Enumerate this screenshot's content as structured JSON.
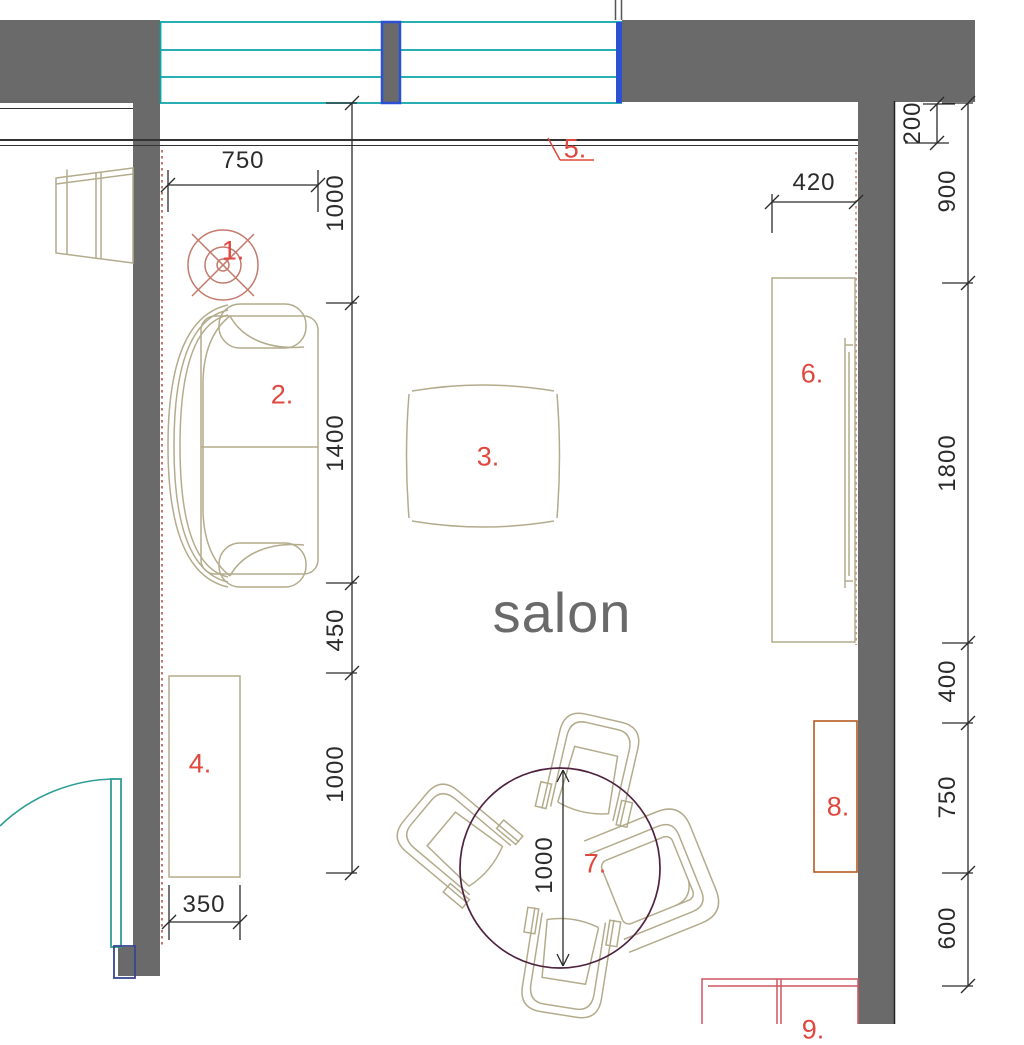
{
  "room_label": "salon",
  "labels": {
    "1": "1.",
    "2": "2.",
    "3": "3.",
    "4": "4.",
    "5": "5.",
    "6": "6.",
    "7": "7.",
    "8": "8.",
    "9": "9."
  },
  "dims": {
    "top_width": "750",
    "left_chain": [
      "1000",
      "1400",
      "450",
      "1000"
    ],
    "cabinet_width": "350",
    "tv_offset": "420",
    "wall_offset": "200",
    "right_chain": [
      "900",
      "1800",
      "400",
      "750",
      "600"
    ],
    "table_diameter": "1000"
  },
  "colors": {
    "wall_gray": "#6a6a6a",
    "window_teal": "#0aa3a8",
    "mullion_blue": "#2b50d4",
    "door_teal": "#2f9e96",
    "door_frame_navy": "#37478f",
    "furniture_beige": "#b3ac8c",
    "label_red": "#e0483f",
    "light_symbol_salmon": "#c4796b",
    "table_plum": "#4f2240",
    "cabinet8_orange": "#b55a1f",
    "sideboard_pink": "#cf5560",
    "dimension_ink": "#2b2b2b",
    "room_label_gray": "#6a6a6a"
  }
}
